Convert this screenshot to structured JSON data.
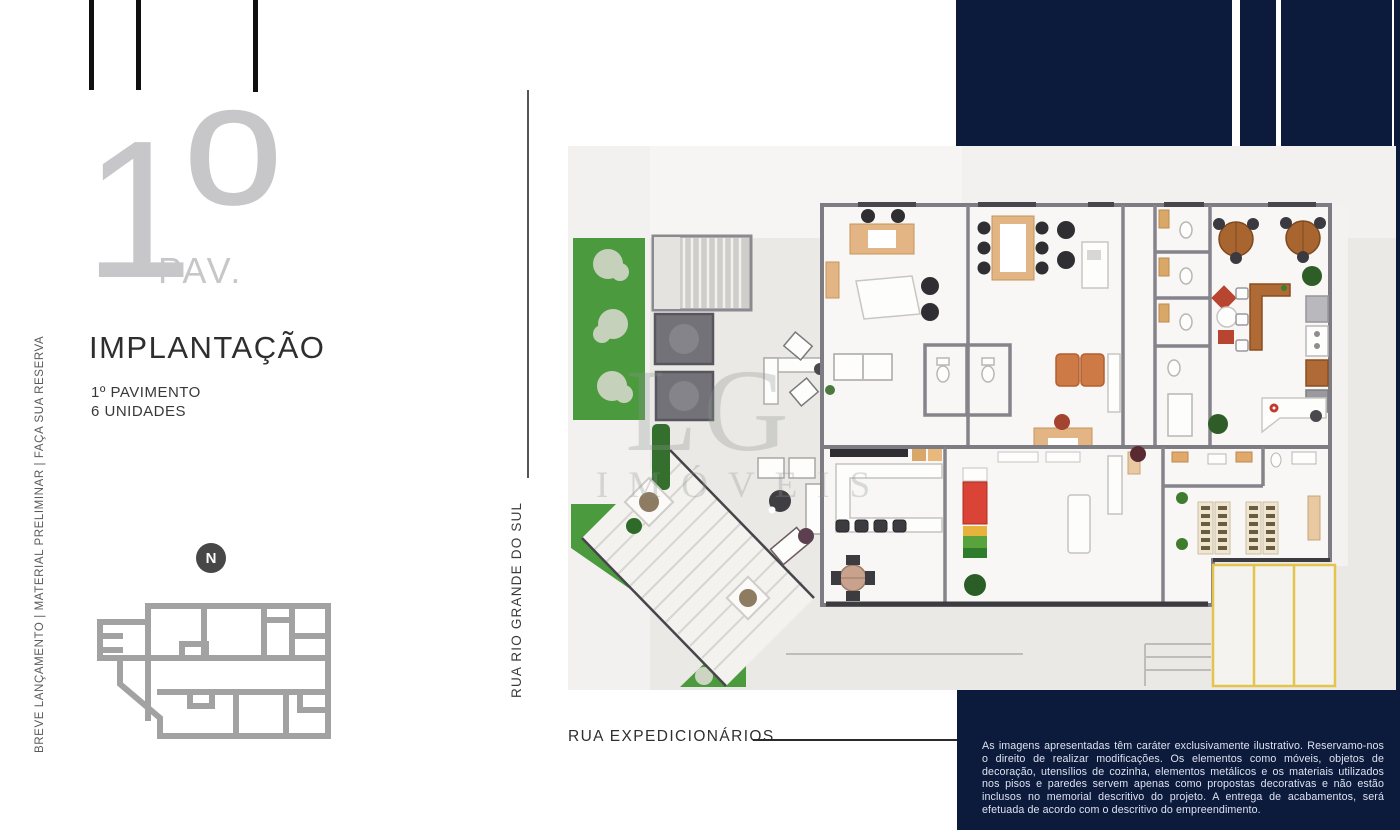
{
  "left_panel": {
    "floor_digit": "1",
    "floor_ordinal": "º",
    "floor_suffix": "PAV.",
    "title": "IMPLANTAÇÃO",
    "subtitle1": "1º PAVIMENTO",
    "subtitle2": "6 UNIDADES",
    "vertical_note": "BREVE LANÇAMENTO | MATERIAL PRELIMINAR | FAÇA SUA RESERVA",
    "compass": "N"
  },
  "plan": {
    "street_left": "RUA RIO GRANDE DO SUL",
    "street_bottom": "RUA EXPEDICIONÁRIOS",
    "watermark_top": "LG",
    "watermark_bottom": "IMÓVEIS"
  },
  "disclaimer": "As imagens apresentadas têm caráter exclusivamente ilustrativo. Reservamo-nos o direito de realizar modificações. Os elementos como móveis, objetos de decoração, utensílios de cozinha, elementos metálicos e os materiais utilizados nos pisos e paredes servem apenas como propostas decorativas e não estão inclusos no memorial descritivo do projeto. A entrega de acabamentos, será efetuada de acordo com o descritivo do empreendimento.",
  "colors": {
    "navy": "#0c1a3c",
    "grass_green": "#4c9a3e",
    "hedge_green": "#33702b",
    "wall_gray": "#7d7c82",
    "plan_bg": "#ebe9e6",
    "accent_tan": "#e3b584",
    "wood_brown": "#a9652f",
    "shelf_red": "#d94436",
    "parking_yellow": "#e4c44c",
    "muted_text": "#c7c7c9",
    "ink": "#2e2e2e"
  }
}
